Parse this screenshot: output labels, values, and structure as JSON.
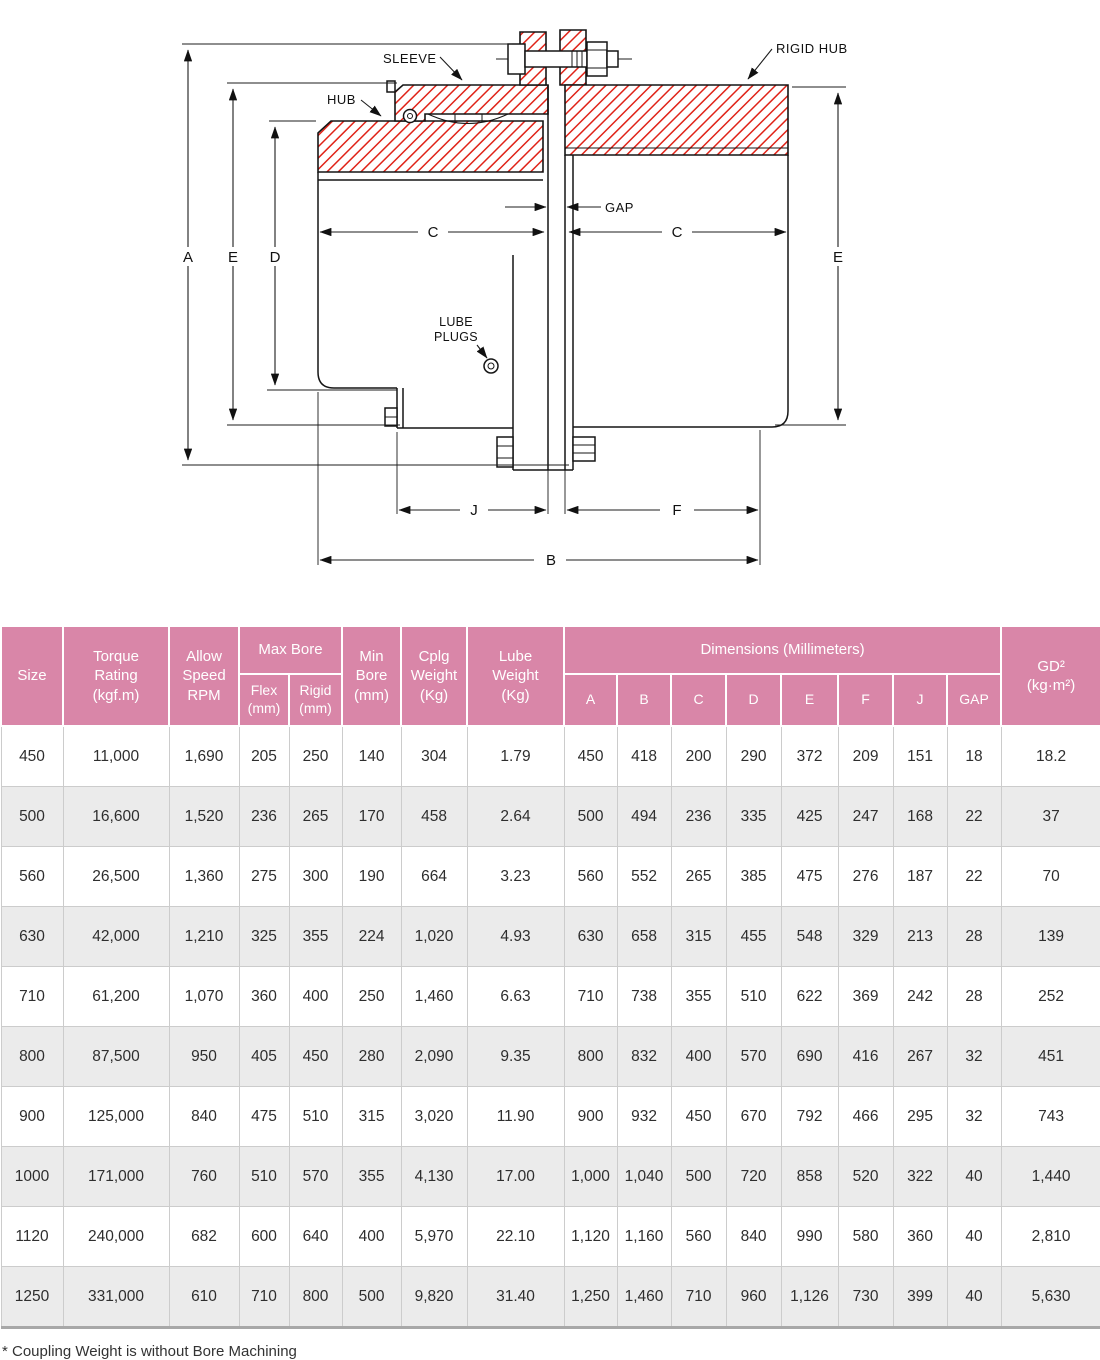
{
  "colors": {
    "accent_pink": "#d986a8",
    "hatch_red": "#e02318",
    "row_alt_gray": "#ebebeb",
    "line_black": "#151515"
  },
  "diagram": {
    "labels": {
      "sleeve": "SLEEVE",
      "hub": "HUB",
      "rigid_hub": "RIGID HUB",
      "gap": "GAP",
      "lube_plugs_line1": "LUBE",
      "lube_plugs_line2": "PLUGS"
    },
    "dims": {
      "A": "A",
      "B": "B",
      "C": "C",
      "D": "D",
      "E": "E",
      "F": "F",
      "J": "J"
    }
  },
  "table": {
    "header": {
      "size": "Size",
      "torque": "Torque\nRating\n(kgf.m)",
      "allow_speed": "Allow\nSpeed\nRPM",
      "max_bore": "Max Bore",
      "flex": "Flex\n(mm)",
      "rigid": "Rigid\n(mm)",
      "min_bore": "Min\nBore\n(mm)",
      "cplg_weight": "Cplg\nWeight\n(Kg)",
      "lube_weight": "Lube\nWeight\n(Kg)",
      "dimensions": "Dimensions (Millimeters)",
      "dim_a": "A",
      "dim_b": "B",
      "dim_c": "C",
      "dim_d": "D",
      "dim_e": "E",
      "dim_f": "F",
      "dim_j": "J",
      "dim_gap": "GAP",
      "gd2": "GD²\n(kg·m²)"
    },
    "rows": [
      [
        "450",
        "11,000",
        "1,690",
        "205",
        "250",
        "140",
        "304",
        "1.79",
        "450",
        "418",
        "200",
        "290",
        "372",
        "209",
        "151",
        "18",
        "18.2"
      ],
      [
        "500",
        "16,600",
        "1,520",
        "236",
        "265",
        "170",
        "458",
        "2.64",
        "500",
        "494",
        "236",
        "335",
        "425",
        "247",
        "168",
        "22",
        "37"
      ],
      [
        "560",
        "26,500",
        "1,360",
        "275",
        "300",
        "190",
        "664",
        "3.23",
        "560",
        "552",
        "265",
        "385",
        "475",
        "276",
        "187",
        "22",
        "70"
      ],
      [
        "630",
        "42,000",
        "1,210",
        "325",
        "355",
        "224",
        "1,020",
        "4.93",
        "630",
        "658",
        "315",
        "455",
        "548",
        "329",
        "213",
        "28",
        "139"
      ],
      [
        "710",
        "61,200",
        "1,070",
        "360",
        "400",
        "250",
        "1,460",
        "6.63",
        "710",
        "738",
        "355",
        "510",
        "622",
        "369",
        "242",
        "28",
        "252"
      ],
      [
        "800",
        "87,500",
        "950",
        "405",
        "450",
        "280",
        "2,090",
        "9.35",
        "800",
        "832",
        "400",
        "570",
        "690",
        "416",
        "267",
        "32",
        "451"
      ],
      [
        "900",
        "125,000",
        "840",
        "475",
        "510",
        "315",
        "3,020",
        "11.90",
        "900",
        "932",
        "450",
        "670",
        "792",
        "466",
        "295",
        "32",
        "743"
      ],
      [
        "1000",
        "171,000",
        "760",
        "510",
        "570",
        "355",
        "4,130",
        "17.00",
        "1,000",
        "1,040",
        "500",
        "720",
        "858",
        "520",
        "322",
        "40",
        "1,440"
      ],
      [
        "1120",
        "240,000",
        "682",
        "600",
        "640",
        "400",
        "5,970",
        "22.10",
        "1,120",
        "1,160",
        "560",
        "840",
        "990",
        "580",
        "360",
        "40",
        "2,810"
      ],
      [
        "1250",
        "331,000",
        "610",
        "710",
        "800",
        "500",
        "9,820",
        "31.40",
        "1,250",
        "1,460",
        "710",
        "960",
        "1,126",
        "730",
        "399",
        "40",
        "5,630"
      ]
    ]
  },
  "footnote": "* Coupling Weight is without Bore Machining"
}
